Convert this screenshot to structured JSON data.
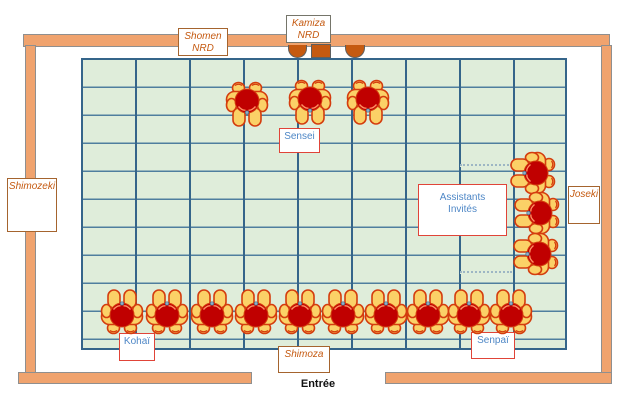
{
  "diagram": {
    "labels": {
      "shomen": "Shomen\nNRD",
      "kamiza": "Kamiza\nNRD",
      "shimozeki": "Shimozeki",
      "joseki": "Joseki",
      "shimoza": "Shimoza",
      "sensei": "Sensei",
      "assistants": "Assistants\nInvités",
      "kohai": "Kohaï",
      "senpai": "Senpaï",
      "entree": "Entrée"
    },
    "colors": {
      "wall": "#F0A36E",
      "wall_outline": "#8F8F8F",
      "tatami": "#DFEDDA",
      "grid_line": "#35658A",
      "grid_line_light": "#4F7E9E",
      "outer_label_text": "#C55A11",
      "outer_label_border": "#A5642E",
      "kamiza_label_border": "#75756A",
      "inner_label_text": "#4E87C6",
      "inner_label_border": "#E04438",
      "person_head": "#C00000",
      "person_limb": "#FBD167",
      "person_outline": "#D43D0E",
      "kamiza_items": "#C55A11"
    },
    "grid": {
      "columns": 9,
      "rows": 10
    },
    "people": {
      "sensei_row": {
        "facing": "down",
        "positions": [
          [
            247,
            104
          ],
          [
            310,
            102
          ],
          [
            368,
            102
          ]
        ]
      },
      "assistants_column": {
        "facing": "left",
        "positions": [
          [
            533,
            173
          ],
          [
            537,
            213
          ],
          [
            536,
            254
          ]
        ]
      },
      "students_row": {
        "facing": "up",
        "positions": [
          [
            122,
            312
          ],
          [
            167,
            312
          ],
          [
            212,
            312
          ],
          [
            256,
            312
          ],
          [
            300,
            312
          ],
          [
            343,
            312
          ],
          [
            386,
            312
          ],
          [
            428,
            312
          ],
          [
            469,
            312
          ],
          [
            511,
            312
          ]
        ]
      }
    }
  }
}
